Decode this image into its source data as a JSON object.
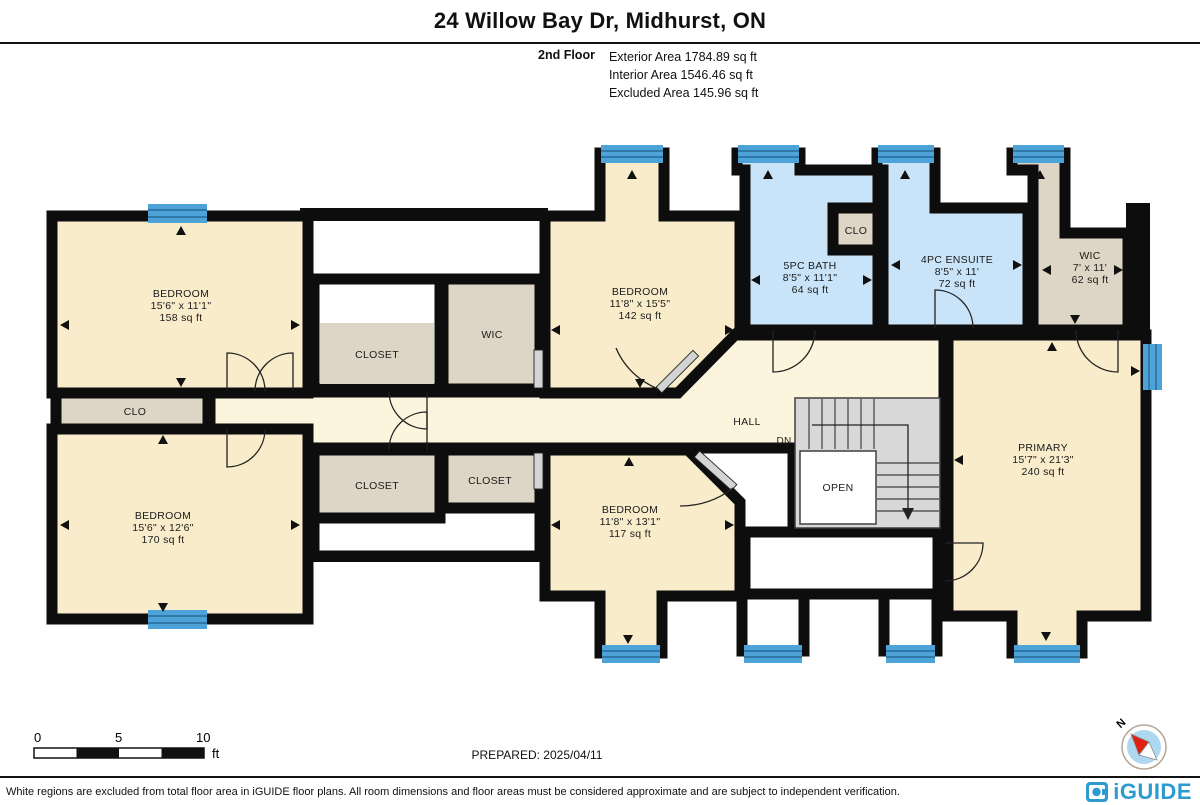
{
  "header": {
    "title": "24 Willow Bay Dr, Midhurst, ON"
  },
  "area_summary": {
    "floor": "2nd Floor",
    "lines": [
      "Exterior Area 1784.89 sq ft",
      "Interior Area 1546.46 sq ft",
      "Excluded Area 145.96 sq ft"
    ]
  },
  "rooms": {
    "bedroom_tl": {
      "name": "BEDROOM",
      "dims": "15'6\" x 11'1\"",
      "area": "158 sq ft"
    },
    "clo_left": {
      "name": "CLO"
    },
    "bedroom_bl": {
      "name": "BEDROOM",
      "dims": "15'6\" x 12'6\"",
      "area": "170 sq ft"
    },
    "closet_top": {
      "name": "CLOSET"
    },
    "wic_center": {
      "name": "WIC"
    },
    "closet_bottom_left": {
      "name": "CLOSET"
    },
    "closet_bottom_center": {
      "name": "CLOSET"
    },
    "bedroom_top_center": {
      "name": "BEDROOM",
      "dims": "11'8\" x 15'5\"",
      "area": "142 sq ft"
    },
    "bath": {
      "name": "5PC BATH",
      "dims": "8'5\" x 11'1\"",
      "area": "64 sq ft"
    },
    "clo_small": {
      "name": "CLO"
    },
    "ensuite": {
      "name": "4PC ENSUITE",
      "dims": "8'5\" x 11'",
      "area": "72 sq ft"
    },
    "wic_right": {
      "name": "WIC",
      "dims": "7' x 11'",
      "area": "62 sq ft"
    },
    "bedroom_bottom_center": {
      "name": "BEDROOM",
      "dims": "11'8\" x 13'1\"",
      "area": "117 sq ft"
    },
    "primary": {
      "name": "PRIMARY",
      "dims": "15'7\" x 21'3\"",
      "area": "240 sq ft"
    },
    "hall": {
      "name": "HALL"
    },
    "stairs": {
      "dn": "DN",
      "open": "OPEN"
    }
  },
  "scale_bar": {
    "tick0": "0",
    "tick5": "5",
    "tick10": "10",
    "unit": "ft"
  },
  "prepared": "PREPARED: 2025/04/11",
  "compass": {
    "label": "N"
  },
  "footer": {
    "disclaimer": "White regions are excluded from total floor area in iGUIDE floor plans. All room dimensions and floor areas must be considered approximate and are subject to independent verification.",
    "brand": "iGUIDE"
  },
  "colors": {
    "room_fill": "#f8ecca",
    "hall_fill": "#fcf4dc",
    "closet_fill": "#ddd5c5",
    "bath_fill": "#c9e4f8",
    "window_blue": "#4da3d8",
    "wall": "#0d0d0d",
    "stairs_gray": "#d8d8d8",
    "brand_blue": "#2e9ad2"
  }
}
